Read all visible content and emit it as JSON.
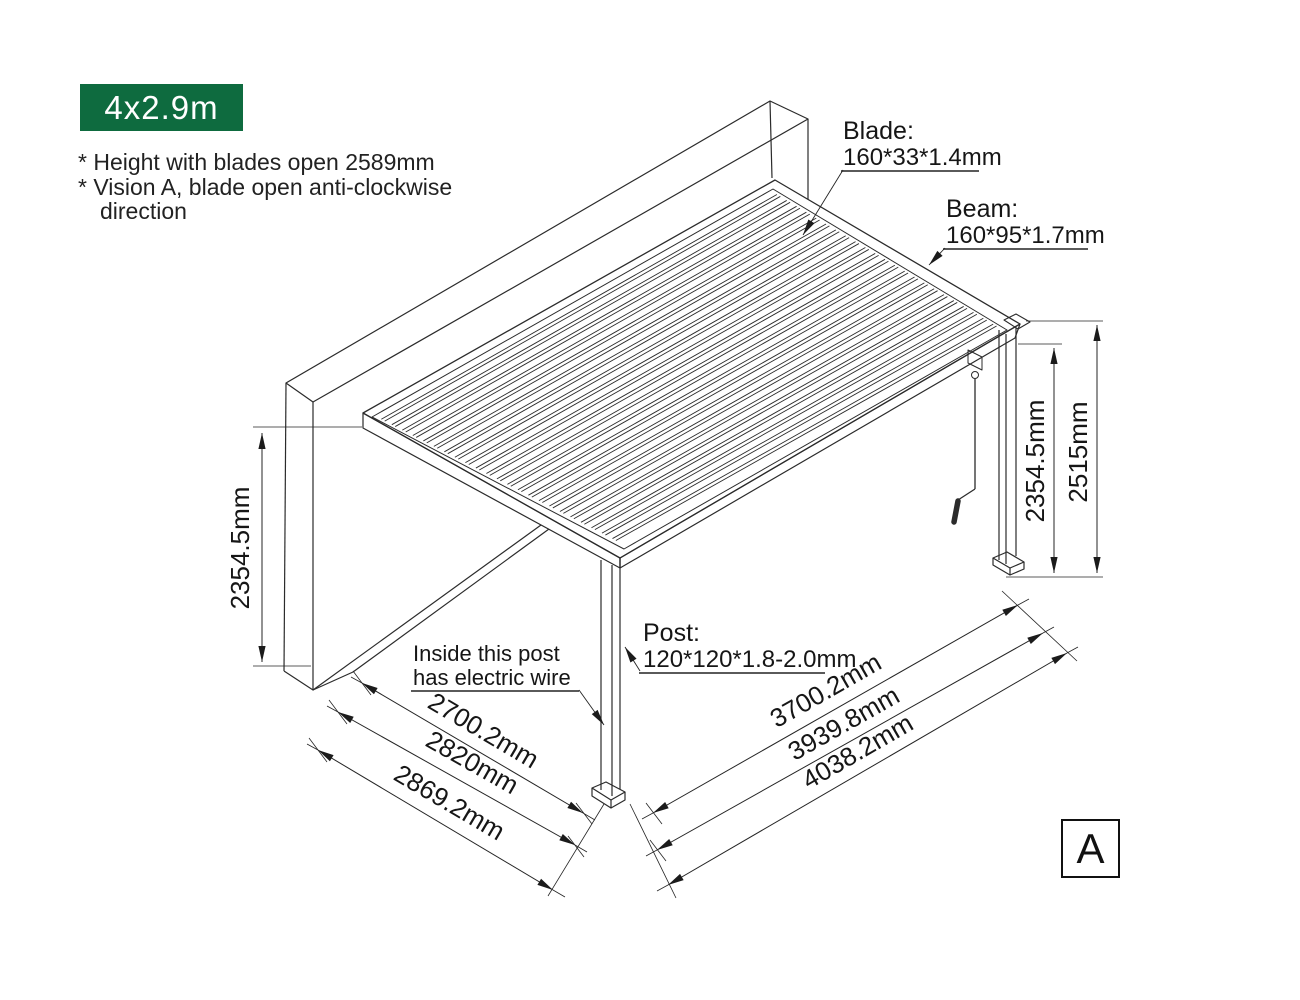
{
  "badge": {
    "label": "4x2.9m",
    "bg": "#0e6b3f",
    "fg": "#ffffff"
  },
  "notes": [
    "* Height with blades open 2589mm",
    "* Vision A, blade open anti-clockwise",
    "direction"
  ],
  "callouts": {
    "blade": {
      "title": "Blade:",
      "spec": "160*33*1.4mm"
    },
    "beam": {
      "title": "Beam:",
      "spec": "160*95*1.7mm"
    },
    "post": {
      "title": "Post:",
      "spec": "120*120*1.8-2.0mm"
    },
    "electric_wire": {
      "line1": "Inside this post",
      "line2": "has electric wire"
    }
  },
  "dimensions": {
    "wall_height": "2354.5mm",
    "post_height": "2354.5mm",
    "total_height": "2515mm",
    "depth_inner": "2700.2mm",
    "depth_mid": "2820mm",
    "depth_outer": "2869.2mm",
    "width_inner": "3700.2mm",
    "width_mid": "3939.8mm",
    "width_outer": "4038.2mm"
  },
  "view_label": "A",
  "drawing": {
    "blade_count": 23,
    "line_color": "#2b2b2b"
  }
}
